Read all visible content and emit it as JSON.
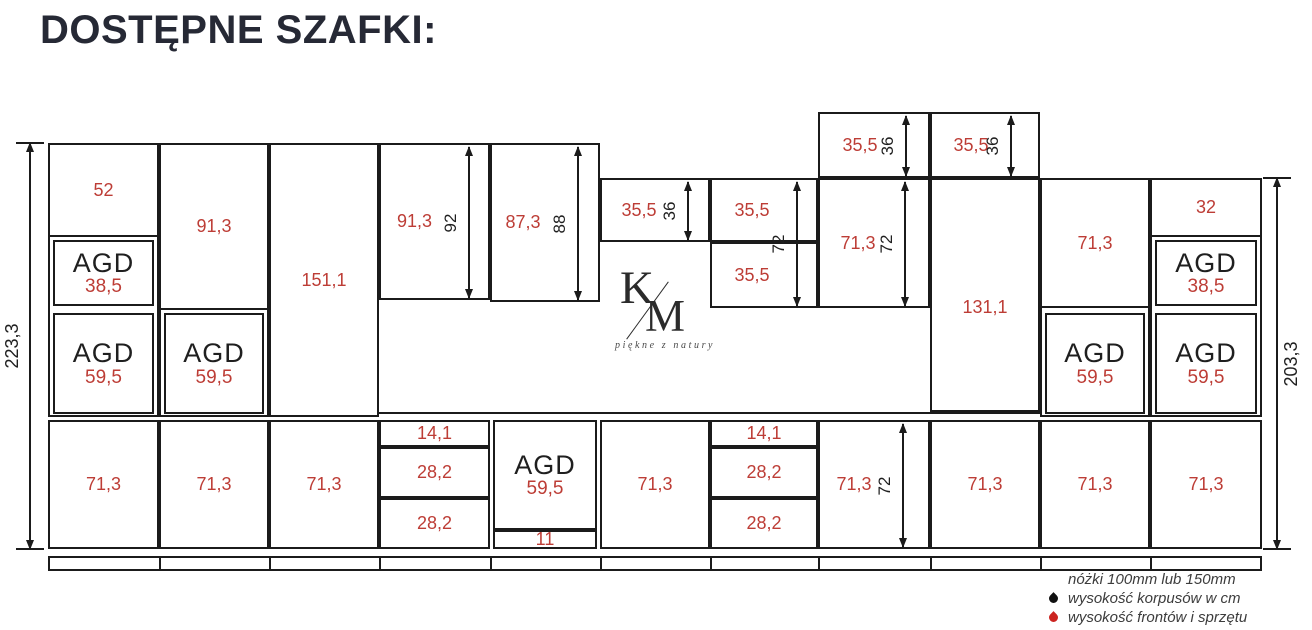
{
  "title": "DOSTĘPNE SZAFKI:",
  "colors": {
    "line": "#1b1b1b",
    "red_label": "#bd3d36",
    "title": "#262935",
    "legend_text": "#3c3c3c",
    "drop_black": "#111111",
    "drop_red": "#cc2420"
  },
  "logo": {
    "k": "K",
    "m": "M",
    "tagline": "piękne z natury"
  },
  "legend": {
    "line1": "nóżki 100mm lub 150mm",
    "line2": "wysokość korpusów w cm",
    "line3": "wysokość frontów i sprzętu"
  },
  "diagram": {
    "outlines": [
      {
        "x": 48,
        "y": 143,
        "w": 111,
        "h": 274
      },
      {
        "x": 159,
        "y": 143,
        "w": 110,
        "h": 274
      },
      {
        "x": 1040,
        "y": 178,
        "w": 110,
        "h": 239
      },
      {
        "x": 1150,
        "y": 178,
        "w": 112,
        "h": 239
      }
    ],
    "boxes": [
      {
        "x": 48,
        "y": 143,
        "w": 111,
        "h": 94,
        "label": "52"
      },
      {
        "x": 53,
        "y": 240,
        "w": 101,
        "h": 66,
        "type": "agd",
        "title": "AGD",
        "value": "38,5"
      },
      {
        "x": 53,
        "y": 313,
        "w": 101,
        "h": 101,
        "type": "agd",
        "title": "AGD",
        "value": "59,5"
      },
      {
        "x": 48,
        "y": 420,
        "w": 111,
        "h": 129,
        "label": "71,3"
      },
      {
        "x": 159,
        "y": 143,
        "w": 110,
        "h": 167,
        "label": "91,3"
      },
      {
        "x": 164,
        "y": 313,
        "w": 100,
        "h": 101,
        "type": "agd",
        "title": "AGD",
        "value": "59,5"
      },
      {
        "x": 159,
        "y": 420,
        "w": 110,
        "h": 129,
        "label": "71,3"
      },
      {
        "x": 269,
        "y": 143,
        "w": 110,
        "h": 274,
        "label": "151,1"
      },
      {
        "x": 269,
        "y": 420,
        "w": 110,
        "h": 129,
        "label": "71,3"
      },
      {
        "x": 379,
        "y": 143,
        "w": 111,
        "h": 157,
        "label": "91,3",
        "dx": -20
      },
      {
        "x": 379,
        "y": 420,
        "w": 111,
        "h": 27,
        "label": "14,1"
      },
      {
        "x": 379,
        "y": 447,
        "w": 111,
        "h": 51,
        "label": "28,2"
      },
      {
        "x": 379,
        "y": 498,
        "w": 111,
        "h": 51,
        "label": "28,2"
      },
      {
        "x": 490,
        "y": 143,
        "w": 110,
        "h": 159,
        "label": "87,3",
        "dx": -22
      },
      {
        "x": 493,
        "y": 420,
        "w": 104,
        "h": 110,
        "type": "agd",
        "title": "AGD",
        "value": "59,5"
      },
      {
        "x": 493,
        "y": 530,
        "w": 104,
        "h": 19,
        "label": "11"
      },
      {
        "x": 600,
        "y": 178,
        "w": 110,
        "h": 64,
        "label": "35,5",
        "dx": -16
      },
      {
        "x": 600,
        "y": 420,
        "w": 110,
        "h": 129,
        "label": "71,3"
      },
      {
        "x": 710,
        "y": 178,
        "w": 108,
        "h": 64,
        "label": "35,5",
        "dx": -12
      },
      {
        "x": 710,
        "y": 242,
        "w": 108,
        "h": 66,
        "label": "35,5",
        "dx": -12
      },
      {
        "x": 818,
        "y": 112,
        "w": 112,
        "h": 66,
        "label": "35,5",
        "dx": -14
      },
      {
        "x": 930,
        "y": 112,
        "w": 110,
        "h": 66,
        "label": "35,5",
        "dx": -14
      },
      {
        "x": 818,
        "y": 178,
        "w": 112,
        "h": 130,
        "label": "71,3",
        "dx": -16
      },
      {
        "x": 930,
        "y": 178,
        "w": 110,
        "h": 234,
        "label": "131,1",
        "dy": 12
      },
      {
        "x": 710,
        "y": 420,
        "w": 108,
        "h": 27,
        "label": "14,1"
      },
      {
        "x": 710,
        "y": 447,
        "w": 108,
        "h": 51,
        "label": "28,2"
      },
      {
        "x": 710,
        "y": 498,
        "w": 108,
        "h": 51,
        "label": "28,2"
      },
      {
        "x": 818,
        "y": 420,
        "w": 112,
        "h": 129,
        "label": "71,3",
        "dx": -20
      },
      {
        "x": 930,
        "y": 420,
        "w": 110,
        "h": 129,
        "label": "71,3"
      },
      {
        "x": 1040,
        "y": 178,
        "w": 110,
        "h": 130,
        "label": "71,3"
      },
      {
        "x": 1045,
        "y": 313,
        "w": 100,
        "h": 101,
        "type": "agd",
        "title": "AGD",
        "value": "59,5"
      },
      {
        "x": 1040,
        "y": 420,
        "w": 110,
        "h": 129,
        "label": "71,3"
      },
      {
        "x": 1150,
        "y": 178,
        "w": 112,
        "h": 59,
        "label": "32"
      },
      {
        "x": 1155,
        "y": 240,
        "w": 102,
        "h": 66,
        "type": "agd",
        "title": "AGD",
        "value": "38,5"
      },
      {
        "x": 1155,
        "y": 313,
        "w": 102,
        "h": 101,
        "type": "agd",
        "title": "AGD",
        "value": "59,5"
      },
      {
        "x": 1150,
        "y": 420,
        "w": 112,
        "h": 129,
        "label": "71,3"
      }
    ],
    "dim_arrows": [
      {
        "x": 469,
        "y1": 147,
        "y2": 298,
        "label": "92"
      },
      {
        "x": 578,
        "y1": 147,
        "y2": 300,
        "label": "88"
      },
      {
        "x": 688,
        "y1": 182,
        "y2": 240,
        "label": "36"
      },
      {
        "x": 797,
        "y1": 182,
        "y2": 306,
        "label": "72"
      },
      {
        "x": 905,
        "y1": 182,
        "y2": 306,
        "label": "72"
      },
      {
        "x": 906,
        "y1": 116,
        "y2": 176,
        "label": "36"
      },
      {
        "x": 1011,
        "y1": 116,
        "y2": 176,
        "label": "36"
      },
      {
        "x": 903,
        "y1": 424,
        "y2": 547,
        "label": "72"
      }
    ],
    "overall_dims": [
      {
        "x": 30,
        "y1": 143,
        "y2": 549,
        "label": "223,3",
        "label_dx": -18
      },
      {
        "x": 1277,
        "y1": 178,
        "y2": 549,
        "label": "203,3",
        "label_dx": 14
      }
    ],
    "counter_line": {
      "x": 379,
      "y": 412,
      "w": 661
    },
    "plinth": {
      "x": 48,
      "y": 556,
      "w": 1214,
      "h": 15,
      "dividers": [
        159,
        269,
        379,
        490,
        600,
        710,
        818,
        930,
        1040,
        1150
      ]
    }
  }
}
